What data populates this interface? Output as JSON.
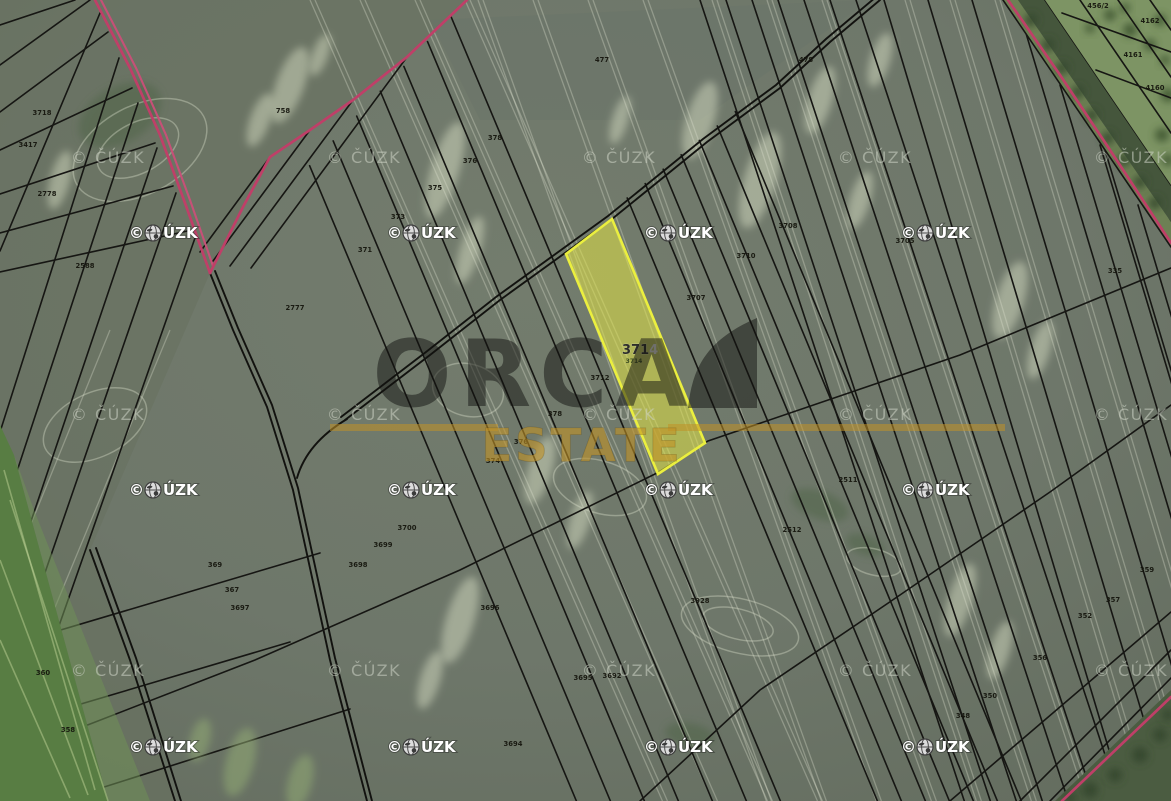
{
  "map": {
    "brand": {
      "name": "ORCA",
      "sub": "ESTATE",
      "accent_color": "#c1922b"
    },
    "highlighted_parcel": {
      "number": "3714",
      "number_prefix": "371",
      "number_suffix": "4",
      "sub_label": "3714",
      "fill_color": "#dce13e",
      "border_color": "#ebef3f"
    },
    "copyright": {
      "full": "© ČÚZK",
      "symbol": "©",
      "after_globe": "ÚZK"
    },
    "parcel_labels": [
      {
        "x": 283,
        "y": 113,
        "t": "758"
      },
      {
        "x": 42,
        "y": 115,
        "t": "3718"
      },
      {
        "x": 28,
        "y": 147,
        "t": "3417"
      },
      {
        "x": 47,
        "y": 196,
        "t": "2778"
      },
      {
        "x": 85,
        "y": 268,
        "t": "2588"
      },
      {
        "x": 495,
        "y": 140,
        "t": "378"
      },
      {
        "x": 470,
        "y": 163,
        "t": "376"
      },
      {
        "x": 435,
        "y": 190,
        "t": "375"
      },
      {
        "x": 398,
        "y": 219,
        "t": "373"
      },
      {
        "x": 365,
        "y": 252,
        "t": "371"
      },
      {
        "x": 295,
        "y": 310,
        "t": "2777"
      },
      {
        "x": 602,
        "y": 62,
        "t": "477"
      },
      {
        "x": 806,
        "y": 62,
        "t": "478"
      },
      {
        "x": 788,
        "y": 228,
        "t": "3708"
      },
      {
        "x": 746,
        "y": 258,
        "t": "3710"
      },
      {
        "x": 696,
        "y": 300,
        "t": "3707"
      },
      {
        "x": 905,
        "y": 243,
        "t": "3705"
      },
      {
        "x": 600,
        "y": 380,
        "t": "3712"
      },
      {
        "x": 555,
        "y": 416,
        "t": "378"
      },
      {
        "x": 521,
        "y": 444,
        "t": "376"
      },
      {
        "x": 493,
        "y": 463,
        "t": "374"
      },
      {
        "x": 848,
        "y": 482,
        "t": "2511"
      },
      {
        "x": 792,
        "y": 532,
        "t": "2512"
      },
      {
        "x": 1115,
        "y": 273,
        "t": "335"
      },
      {
        "x": 1147,
        "y": 572,
        "t": "359"
      },
      {
        "x": 1113,
        "y": 602,
        "t": "357"
      },
      {
        "x": 1085,
        "y": 618,
        "t": "352"
      },
      {
        "x": 1040,
        "y": 660,
        "t": "356"
      },
      {
        "x": 990,
        "y": 698,
        "t": "350"
      },
      {
        "x": 963,
        "y": 718,
        "t": "348"
      },
      {
        "x": 1098,
        "y": 8,
        "t": "456/2"
      },
      {
        "x": 1150,
        "y": 23,
        "t": "4162"
      },
      {
        "x": 1133,
        "y": 57,
        "t": "4161"
      },
      {
        "x": 1155,
        "y": 90,
        "t": "4160"
      },
      {
        "x": 215,
        "y": 567,
        "t": "369"
      },
      {
        "x": 232,
        "y": 592,
        "t": "367"
      },
      {
        "x": 240,
        "y": 610,
        "t": "3697"
      },
      {
        "x": 43,
        "y": 675,
        "t": "360"
      },
      {
        "x": 68,
        "y": 732,
        "t": "358"
      },
      {
        "x": 407,
        "y": 530,
        "t": "3700"
      },
      {
        "x": 383,
        "y": 547,
        "t": "3699"
      },
      {
        "x": 358,
        "y": 567,
        "t": "3698"
      },
      {
        "x": 490,
        "y": 610,
        "t": "3696"
      },
      {
        "x": 583,
        "y": 680,
        "t": "3695"
      },
      {
        "x": 700,
        "y": 603,
        "t": "3928"
      },
      {
        "x": 513,
        "y": 746,
        "t": "3694"
      },
      {
        "x": 612,
        "y": 678,
        "t": "3692"
      }
    ]
  }
}
